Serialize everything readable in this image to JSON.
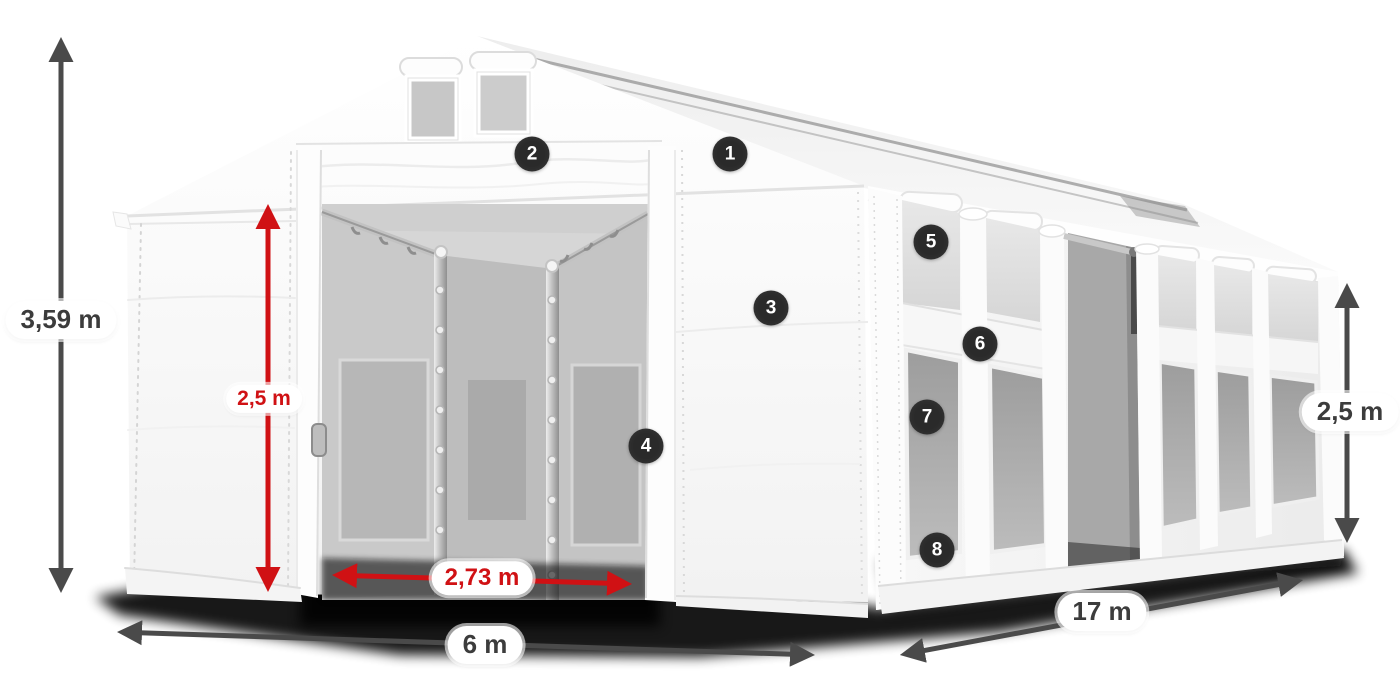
{
  "markers": [
    {
      "label": "1"
    },
    {
      "label": "2"
    },
    {
      "label": "3"
    },
    {
      "label": "4"
    },
    {
      "label": "5"
    },
    {
      "label": "6"
    },
    {
      "label": "7"
    },
    {
      "label": "8"
    }
  ],
  "dimensions": {
    "total_height": {
      "text": "3,59 m"
    },
    "inner_clear_height": {
      "text": "2,5 m"
    },
    "entrance_width": {
      "text": "2,73 m"
    },
    "width": {
      "text": "6 m"
    },
    "length": {
      "text": "17 m"
    },
    "side_wall_height": {
      "text": "2,5 m"
    }
  },
  "colors": {
    "dimension_arrow": "#4a4a4a",
    "dimension_red": "#d01114",
    "marker_background": "#2a2a2a",
    "marker_number": "#ffffff",
    "label_background": "#ffffff",
    "label_text_dark": "#3c3c3c"
  }
}
